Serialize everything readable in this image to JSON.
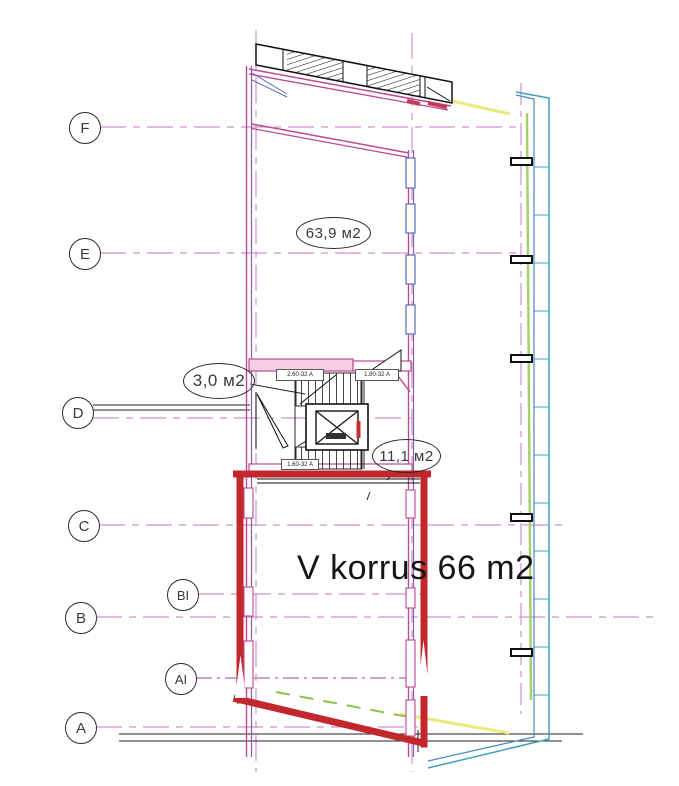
{
  "page": {
    "title": "V korrus 66 m2"
  },
  "grid": {
    "labels": [
      {
        "text": "F"
      },
      {
        "text": "E"
      },
      {
        "text": "D"
      },
      {
        "text": "C"
      },
      {
        "text": "BI"
      },
      {
        "text": "B"
      },
      {
        "text": "AI"
      },
      {
        "text": "A"
      }
    ]
  },
  "areas": [
    {
      "text": "63,9 м2"
    },
    {
      "text": "3,0 м2"
    },
    {
      "text": "11,1 м2"
    }
  ],
  "door_tags": [
    {
      "text": "2.60-32 A"
    },
    {
      "text": "1.80-32 A"
    },
    {
      "text": "1.60-32 A"
    }
  ],
  "colors": {
    "highlight_red": "#c2272d",
    "wall_magenta": "#bb4a92",
    "wall_crimson": "#c23a56",
    "grid_magenta": "#cf92cf",
    "window_blue": "#5b6cb8",
    "facade_cyan": "#3fa0c0",
    "facade_green": "#a6d066",
    "accent_yellow": "#ece97f",
    "line_black": "#1d1d1d"
  }
}
